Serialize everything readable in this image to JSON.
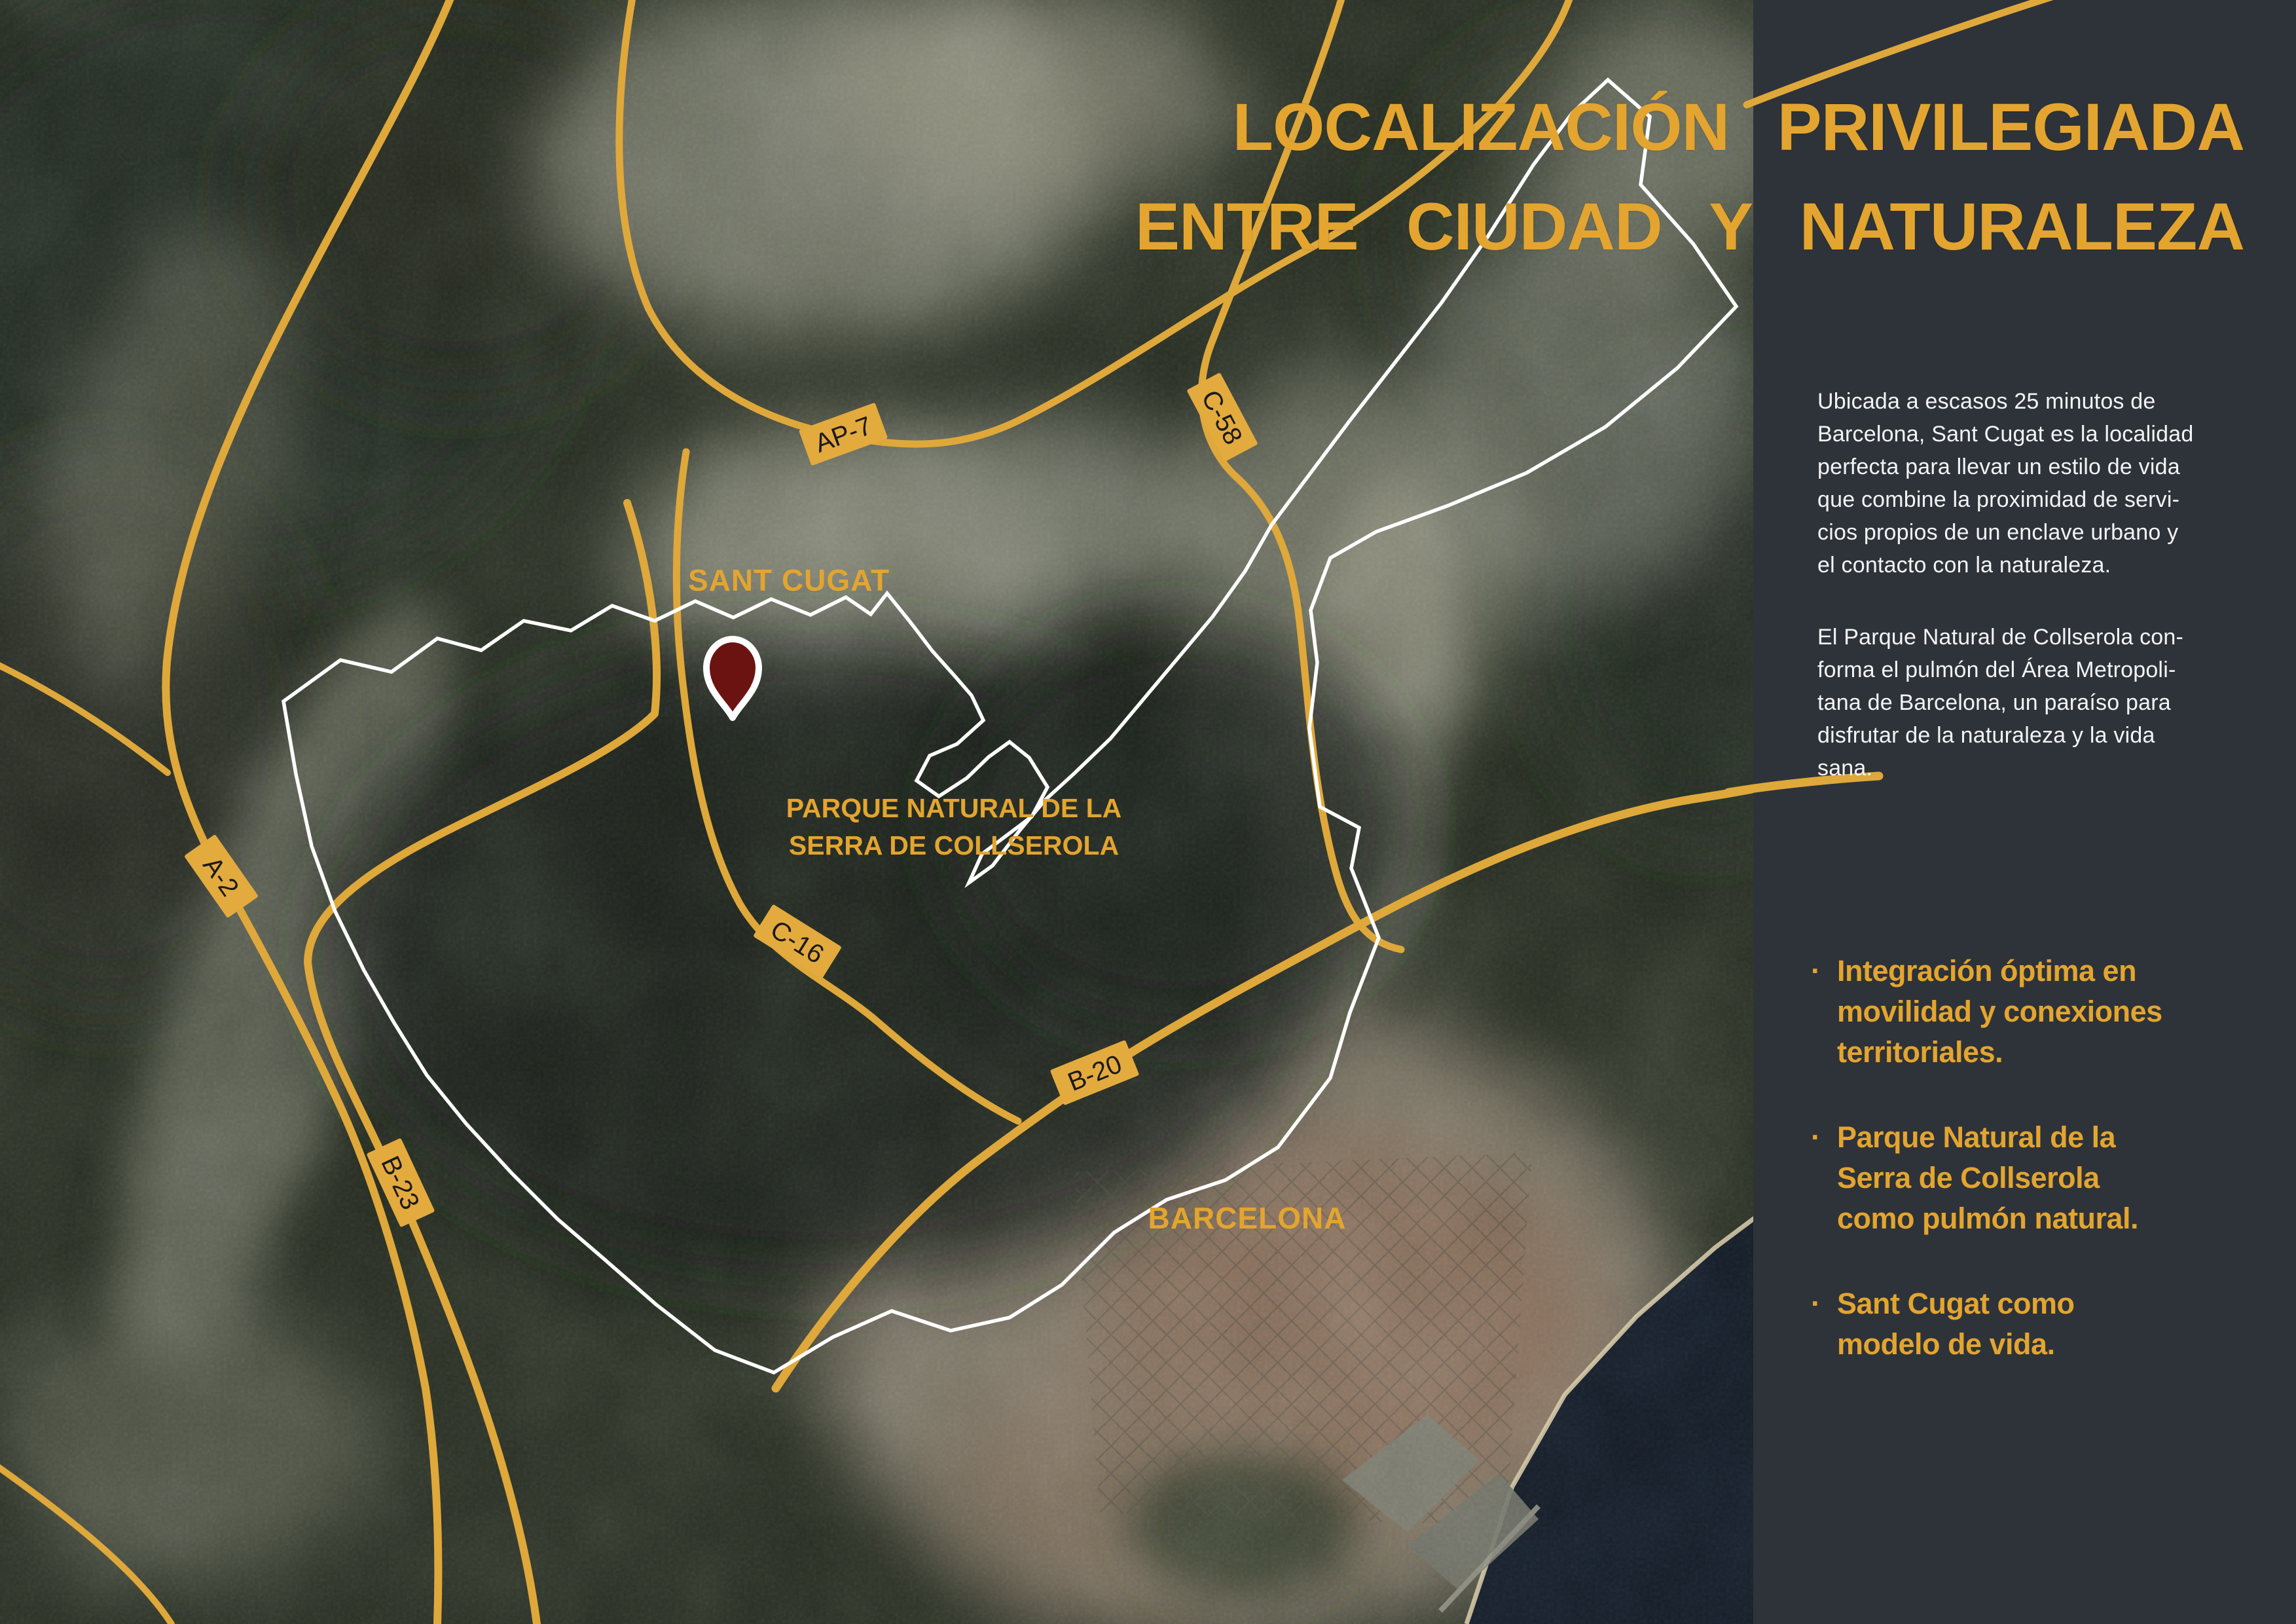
{
  "slide": {
    "title_lines": [
      "LOCALIZACIÓN PRIVILEGIADA",
      "ENTRE CIUDAD Y NATURALEZA"
    ],
    "accent_color": "#E3A52F"
  },
  "map": {
    "labels": {
      "sant_cugat": "SANT CUGAT",
      "park_line_1": "PARQUE NATURAL DE LA",
      "park_line_2": "SERRA DE COLLSEROLA",
      "barcelona": "BARCELONA"
    },
    "road_shields": [
      "AP-7",
      "C-58",
      "A-2",
      "C-16",
      "B-20",
      "B-23"
    ],
    "colors": {
      "road_yellow": "#DFA83B",
      "park_outline": "#FFFFFF",
      "pin_red": "#6B1310",
      "sea": "#131A24"
    }
  },
  "sidebar": {
    "background": "#2E333A",
    "text_color": "#F4F4F4",
    "paragraphs": [
      {
        "lines": [
          "Ubicada a escasos 25 minutos de",
          "Barcelona, Sant Cugat es la localidad",
          "perfecta para llevar un estilo de vida",
          "que combine la proximidad de servi-",
          "cios propios de un enclave urbano y",
          "el contacto con la naturaleza."
        ]
      },
      {
        "lines": [
          "El Parque Natural de Collserola con-",
          "forma el pulmón del Área Metropoli-",
          "tana de Barcelona, un paraíso para",
          "disfrutar de la naturaleza y la vida",
          "sana."
        ]
      }
    ],
    "bullets": [
      {
        "marker": "·",
        "lines": [
          "Integración óptima en",
          "movilidad y conexiones",
          "territoriales."
        ]
      },
      {
        "marker": "·",
        "lines": [
          "Parque Natural de la",
          "Serra de Collserola",
          "como pulmón natural."
        ]
      },
      {
        "marker": "·",
        "lines": [
          "Sant Cugat como",
          "modelo de vida."
        ]
      }
    ]
  }
}
